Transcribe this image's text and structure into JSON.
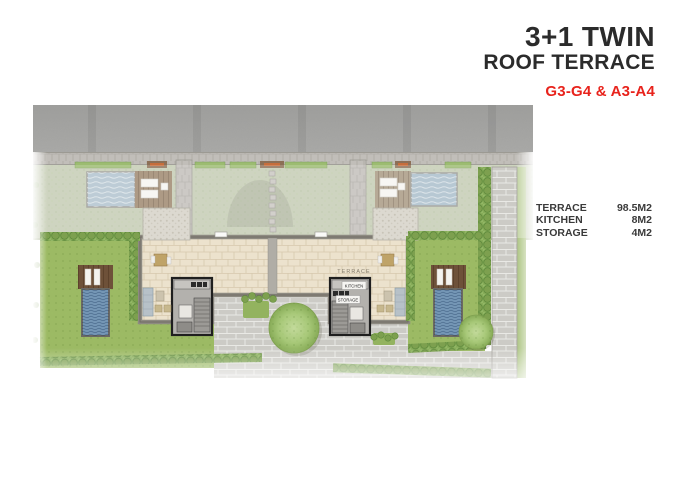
{
  "header": {
    "title_line1": "3+1 TWIN",
    "title_line2": "ROOF TERRACE",
    "unit_code": "G3-G4 & A3-A4"
  },
  "specs": {
    "rows": [
      {
        "label": "TERRACE",
        "value": "98.5M2"
      },
      {
        "label": "KITCHEN",
        "value": "8M2"
      },
      {
        "label": "STORAGE",
        "value": "4M2"
      }
    ]
  },
  "plan": {
    "labels": {
      "terrace": "TERRACE",
      "kitchen": "KITCHEN",
      "storage": "STORAGE"
    },
    "colors": {
      "accent_red": "#e8231c",
      "lawn_green": "#9cba64",
      "faded_lawn_green": "#bcc4a9",
      "upper_pool_blue": "#a1b6c5",
      "side_pool_blue": "#7496b5",
      "deck_brown": "#8f7558",
      "terrace_paver_beige": "#ece2cd",
      "plaza_stone_gray": "#cccbc6",
      "road_asphalt_gray": "#a4a4a2",
      "hedge_green": "#7da04f"
    }
  }
}
